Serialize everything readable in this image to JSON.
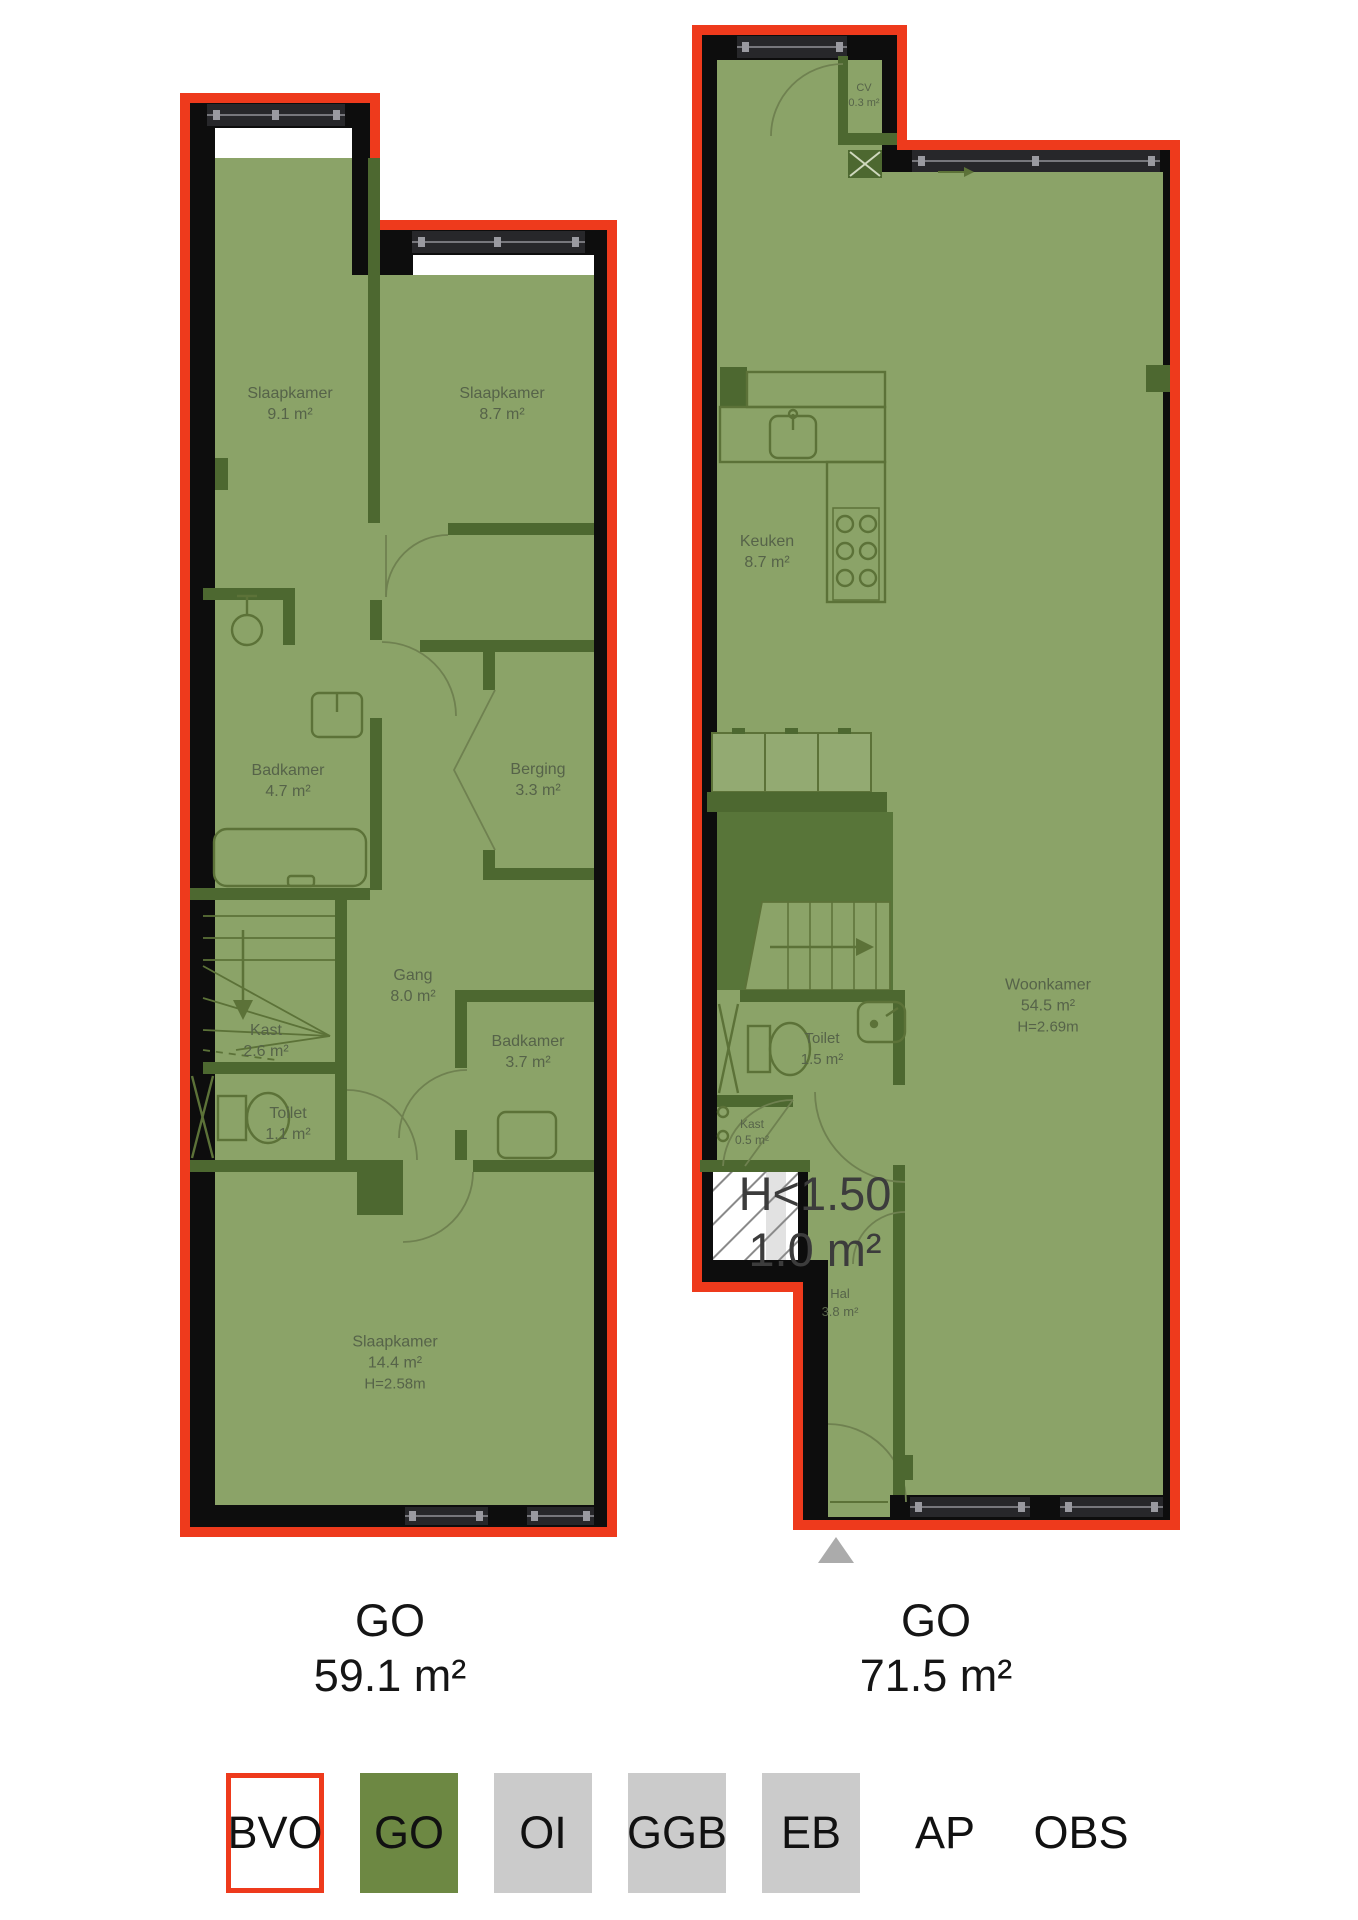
{
  "title": "Floor plans with NEN2580 area measurement",
  "left_plan": {
    "rooms": [
      {
        "name": "Slaapkamer",
        "area": "9.1 m²"
      },
      {
        "name": "Slaapkamer",
        "area": "8.7 m²"
      },
      {
        "name": "Badkamer",
        "area": "4.7 m²"
      },
      {
        "name": "Berging",
        "area": "3.3 m²"
      },
      {
        "name": "Gang",
        "area": "8.0 m²"
      },
      {
        "name": "Kast",
        "area": "2.6 m²"
      },
      {
        "name": "Toilet",
        "area": "1.1 m²"
      },
      {
        "name": "Badkamer",
        "area": "3.7 m²"
      },
      {
        "name": "Slaapkamer",
        "area": "14.4 m²",
        "height": "H=2.58m"
      }
    ],
    "total_label": "GO",
    "total_area": "59.1 m²"
  },
  "right_plan": {
    "rooms": [
      {
        "name": "CV",
        "area": "0.3 m²"
      },
      {
        "name": "Keuken",
        "area": "8.7 m²"
      },
      {
        "name": "Woonkamer",
        "area": "54.5 m²",
        "height": "H=2.69m"
      },
      {
        "name": "Toilet",
        "area": "1.5 m²"
      },
      {
        "name": "Kast",
        "area": "0.5 m²"
      },
      {
        "name": "Hal",
        "area": "3.8 m²"
      },
      {
        "name": "H<1.50",
        "area": "1.0 m²"
      }
    ],
    "total_label": "GO",
    "total_area": "71.5 m²"
  },
  "legend": {
    "items": [
      {
        "label": "BVO",
        "style": "bvo"
      },
      {
        "label": "GO",
        "style": "go"
      },
      {
        "label": "OI",
        "style": "gray"
      },
      {
        "label": "GGB",
        "style": "gray"
      },
      {
        "label": "EB",
        "style": "gray"
      },
      {
        "label": "AP",
        "style": "none"
      },
      {
        "label": "OBS",
        "style": "none"
      }
    ]
  },
  "colors": {
    "bvo_red": "#ee3a1c",
    "go_green_fill": "#8ba368",
    "go_legend_green": "#6d8843",
    "legend_gray": "#cbcbcb",
    "wall_black": "#0d0d0d",
    "interior_wall": "#4d6830",
    "stair_void": "#587539"
  }
}
